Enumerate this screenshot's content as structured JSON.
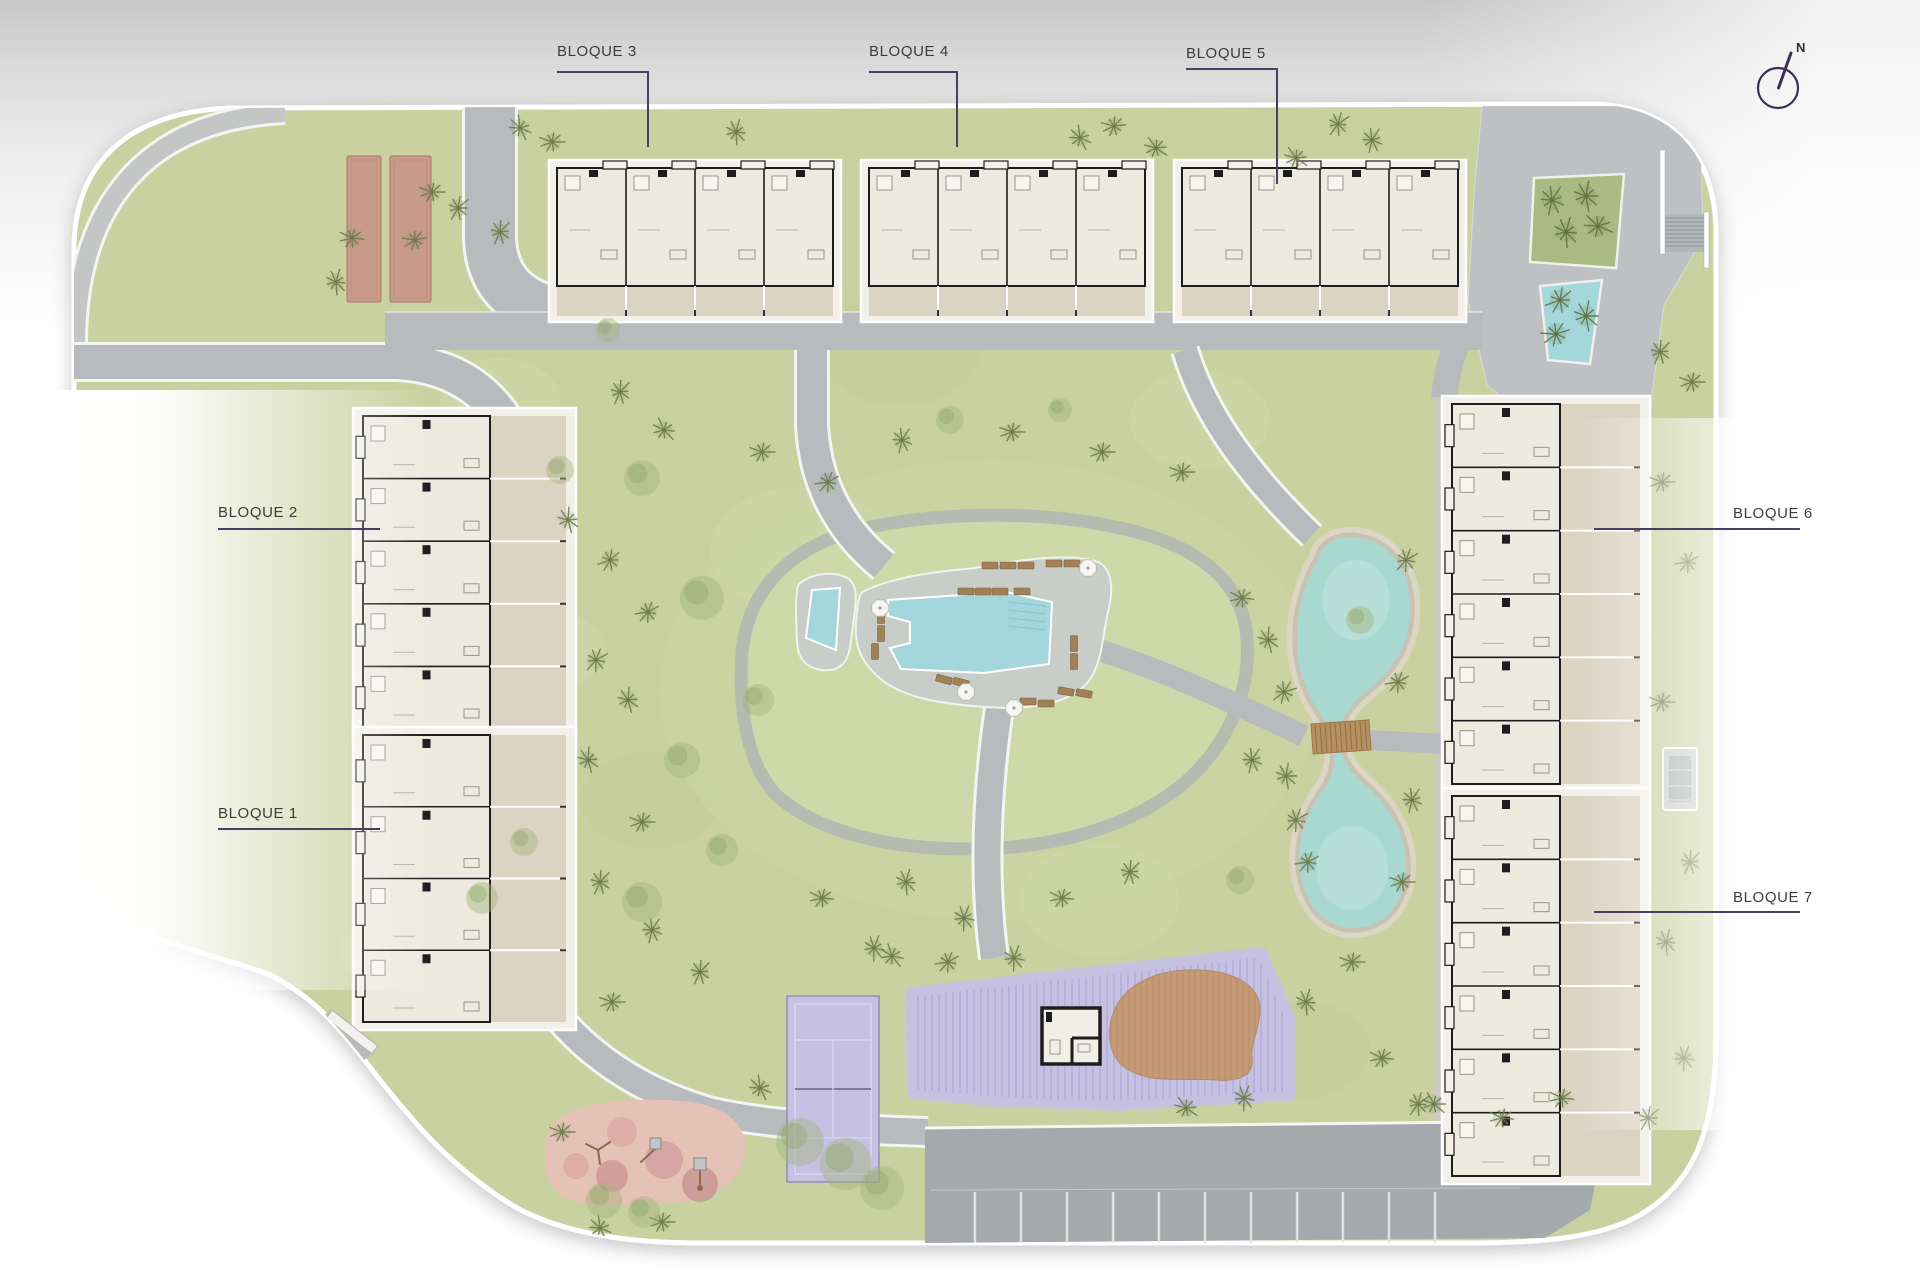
{
  "labels": {
    "bloque1": "BLOQUE 1",
    "bloque2": "BLOQUE 2",
    "bloque3": "BLOQUE 3",
    "bloque4": "BLOQUE 4",
    "bloque5": "BLOQUE 5",
    "bloque6": "BLOQUE 6",
    "bloque7": "BLOQUE 7"
  },
  "compass": {
    "label": "N"
  },
  "icons": {
    "compass": "north-arrow-icon"
  },
  "colors": {
    "grass": "#c9d1a0",
    "grass_light": "#d6ddb4",
    "grass_dark": "#bfca96",
    "path_gray": "#b7bbbd",
    "path_edge": "#f4f4f1",
    "stone": "#cdcabf",
    "plaza": "#bdc1c3",
    "parking": "#a4aaac",
    "water": "#a3d7db",
    "lake_water": "#a8d8d0",
    "sand": "#dbd6c6",
    "stone_ring": "#c7c2b2",
    "purple": "#c6c1e2",
    "purple_stripe": "#b2acd4",
    "brown_blob": "#c59a77",
    "brown_stripe": "#b78c69",
    "terracotta": "#c89a89",
    "terracotta_edge": "#b07f6d",
    "playground_pink": "#e5c2b5",
    "playground_circle": "#d19f9f",
    "building_cream": "#edeadf",
    "building_wall": "#1d1d1d",
    "terrace_tan": "#dcd4c3",
    "pad_white": "#f2f0e9",
    "lounger_brown": "#a08158",
    "umbrella_white": "#f6f5f1",
    "bridge_wood": "#b6915f",
    "tree_green": "#6b7a4a",
    "bush_green": "#a3b37c",
    "label_text": "#3c3c3c",
    "label_line": "#4a3f63",
    "compass_line": "#3b2f55"
  }
}
